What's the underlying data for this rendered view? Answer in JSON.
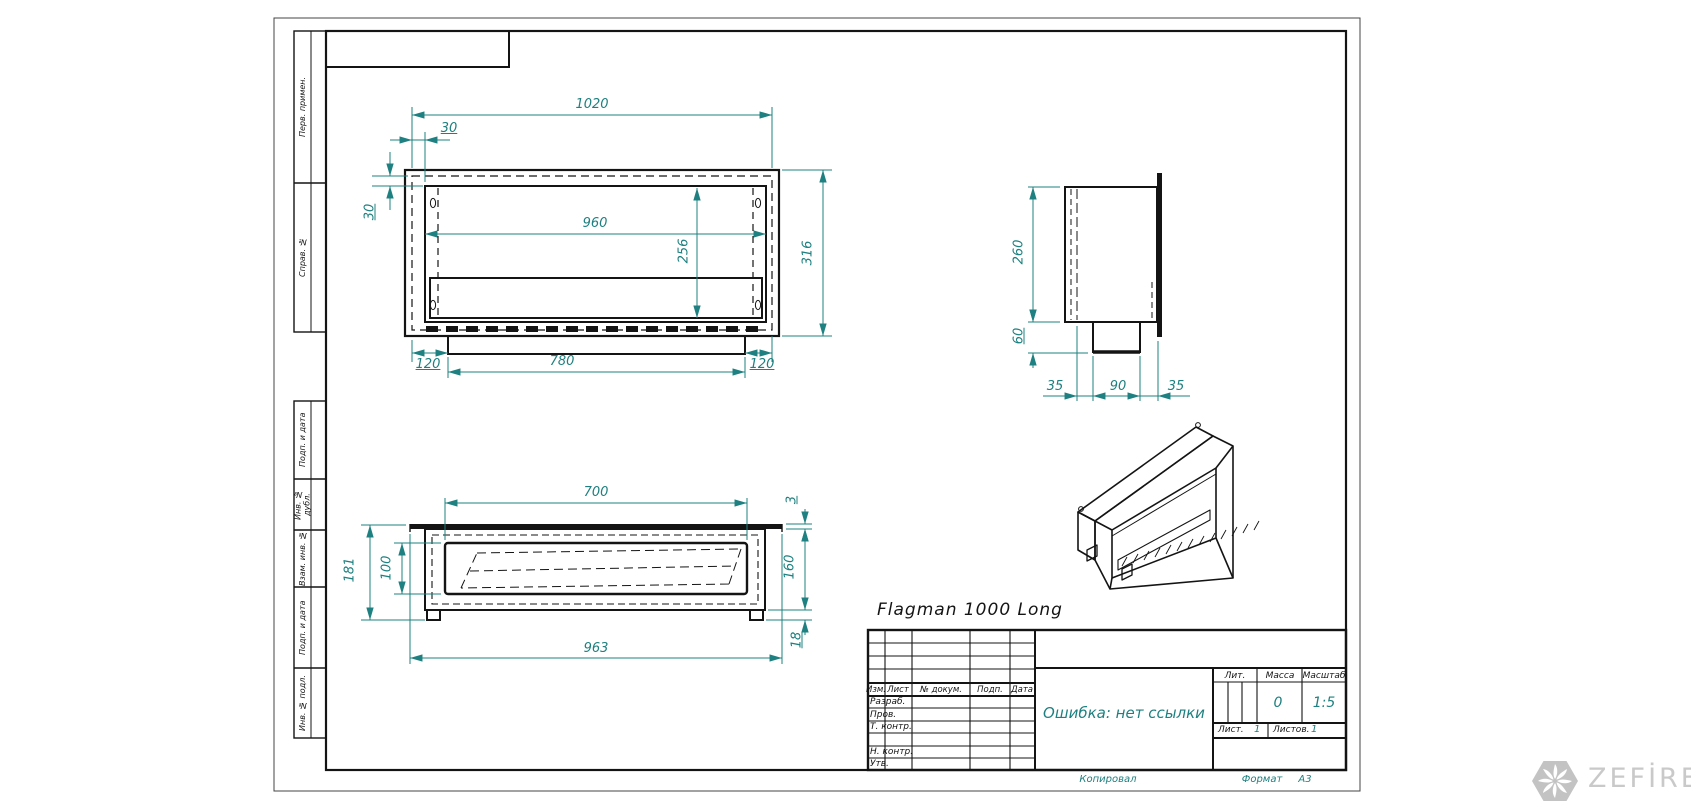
{
  "drawing_title": "Flagman 1000 Long",
  "colors": {
    "dimension": "#1e8080",
    "line": "#141414",
    "logo_gray": "#c3c3c3"
  },
  "margin_labels": {
    "top": [
      "Перв. примен.",
      "Справ. №"
    ],
    "bottom": [
      "Подп. и дата",
      "Инв. № дубл.",
      "Взам. инв. №",
      "Подп. и дата",
      "Инв. № подл."
    ]
  },
  "dims": {
    "front": {
      "total_width": "1020",
      "offset_top": "30",
      "offset_side": "30",
      "opening_width": "960",
      "opening_height": "256",
      "total_height": "316",
      "base_inset_left": "120",
      "base_width": "780",
      "base_inset_right": "120"
    },
    "side": {
      "body_height": "260",
      "base_height": "60",
      "inset_left": "35",
      "base_width": "90",
      "inset_right": "35"
    },
    "plan": {
      "opening_width": "700",
      "flange_thickness": "3",
      "total_depth": "181",
      "opening_depth": "100",
      "body_depth": "160",
      "flange_width": "963",
      "feet_height": "18"
    }
  },
  "title_block": {
    "header_cols": {
      "izm": "Изм.",
      "list": "Лист",
      "ndokum": "№ докум.",
      "podp": "Подп.",
      "data": "Дата"
    },
    "rows": {
      "razrab": "Разраб.",
      "prov": "Пров.",
      "tkontr": "Т. контр.",
      "nkontr": "Н. контр.",
      "utv": "Утв."
    },
    "lit_label": "Лит.",
    "massa_label": "Масса",
    "masshtab_label": "Масштаб",
    "massa_value": "0",
    "masshtab_value": "1:5",
    "list_label": "Лист.",
    "list_value": "1",
    "listov_label": "Листов.",
    "listov_value": "1",
    "doc_name": "Ошибка: нет ссылки"
  },
  "footer": {
    "kopiroval": "Копировал",
    "format_label": "Формат",
    "format_value": "А3"
  },
  "logo": {
    "text": "ZEFİRE"
  }
}
